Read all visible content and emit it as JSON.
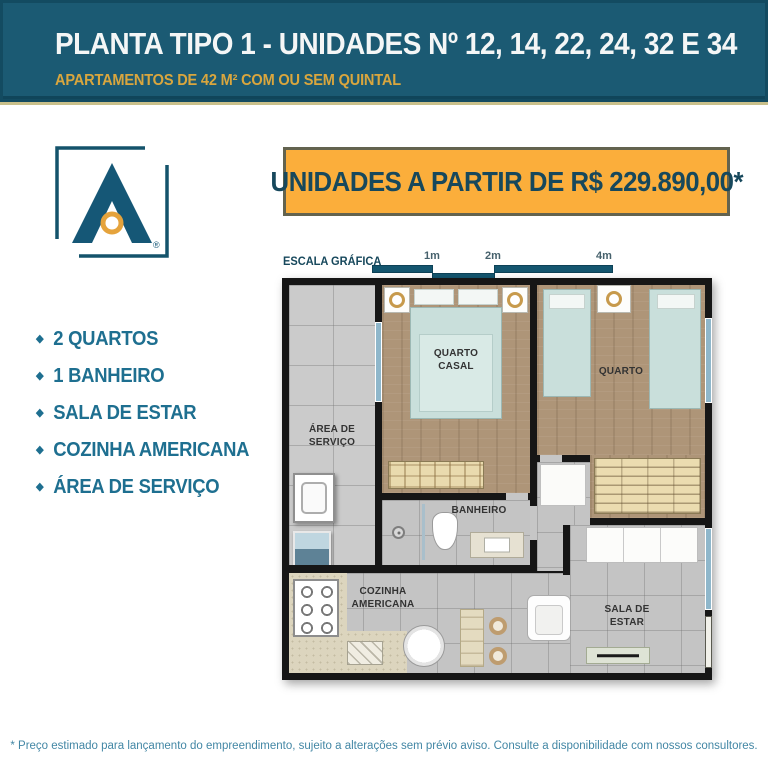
{
  "header": {
    "title": "PLANTA TIPO 1 - UNIDADES Nº 12, 14, 22, 24, 32 E 34",
    "subtitle": "APARTAMENTOS DE 42 M² COM OU SEM QUINTAL"
  },
  "logo": {
    "registered_mark": "®"
  },
  "price_banner": {
    "text": "UNIDADES A PARTIR DE R$ 229.890,00*"
  },
  "scale": {
    "label": "ESCALA GRÁFICA",
    "ticks": [
      "1m",
      "2m",
      "4m"
    ]
  },
  "features": {
    "bullet": "◆",
    "items": [
      "2 QUARTOS",
      "1 BANHEIRO",
      "SALA DE ESTAR",
      "COZINHA AMERICANA",
      "ÁREA DE SERVIÇO"
    ]
  },
  "floorplan": {
    "labels": {
      "quarto_casal": "QUARTO CASAL",
      "quarto": "QUARTO",
      "area_servico": "ÁREA DE SERVIÇO",
      "banheiro": "BANHEIRO",
      "cozinha": "COZINHA AMERICANA",
      "sala": "SALA DE ESTAR"
    }
  },
  "footer": {
    "disclaimer": "* Preço estimado para lançamento do empreendimento, sujeito a alterações sem prévio aviso. Consulte a disponibilidade com nossos consultores."
  },
  "colors": {
    "header_bg": "#1B5A73",
    "header_border": "#134B61",
    "accent_line": "#C9C08B",
    "subtitle_gold": "#D9A63E",
    "banner_gold": "#FBAE3B",
    "teal_text": "#1E6F90",
    "price_text": "#17485C",
    "footer_text": "#4387A5",
    "wall_black": "#161616",
    "wood_floor": "#AE9578",
    "bed_blue": "#C9DFDB"
  }
}
